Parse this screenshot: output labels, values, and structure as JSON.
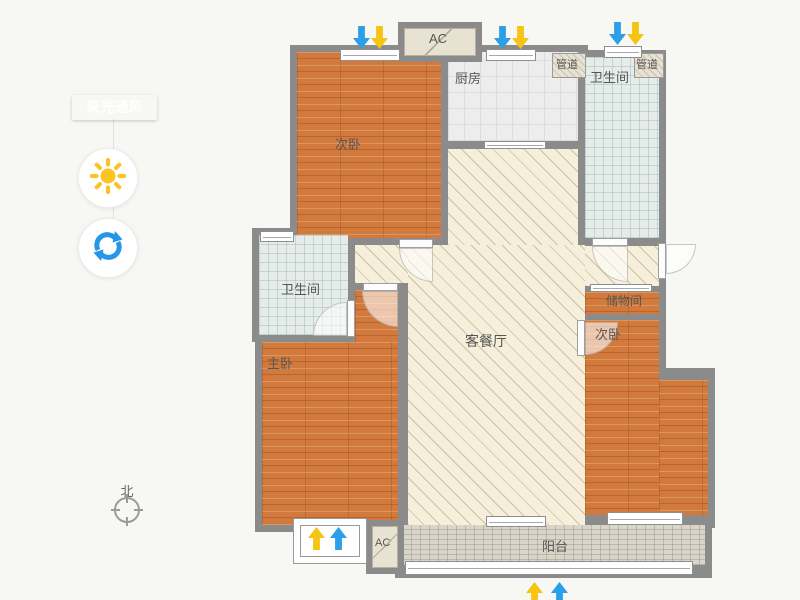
{
  "page": {
    "background": "#f7f7f4"
  },
  "sidebar": {
    "mode_label": "采光通风",
    "accent": "#1b9fe8",
    "buttons": [
      {
        "name": "sun",
        "meaning": "daylight view"
      },
      {
        "name": "rotate",
        "meaning": "rotate plan"
      }
    ]
  },
  "compass": {
    "label": "北"
  },
  "palette": {
    "wall": "#8b8b8b",
    "wood": "#d2793d",
    "hatch_bg": "#f5efdb",
    "tile_bg": "#ededed",
    "bath_bg": "#e5ece9",
    "balcony_bg": "#d9d5c8",
    "beige": "#e8e2d2",
    "arrow_blue": "#2b9fe8",
    "arrow_yellow": "#f6c413",
    "label_color": "#565656"
  },
  "floorplan": {
    "walls": [
      [
        290,
        45,
        158,
        203
      ],
      [
        441,
        45,
        147,
        103
      ],
      [
        578,
        50,
        88,
        195
      ],
      [
        441,
        141,
        147,
        111
      ],
      [
        252,
        228,
        103,
        114
      ],
      [
        255,
        283,
        157,
        249
      ],
      [
        348,
        238,
        240,
        294
      ],
      [
        578,
        225,
        88,
        155
      ],
      [
        578,
        368,
        137,
        160
      ],
      [
        395,
        515,
        317,
        63
      ]
    ],
    "floors": [
      {
        "kind": "wood",
        "r": [
          297,
          52,
          144,
          186
        ],
        "room": "bedroom-top-left"
      },
      {
        "kind": "tile",
        "r": [
          448,
          52,
          130,
          89
        ],
        "room": "kitchen"
      },
      {
        "kind": "bath",
        "r": [
          585,
          57,
          74,
          181
        ],
        "room": "bathroom-right"
      },
      {
        "kind": "hatch",
        "r": [
          448,
          149,
          130,
          96
        ],
        "room": "living-upper"
      },
      {
        "kind": "hatch",
        "r": [
          408,
          245,
          177,
          280
        ],
        "room": "living-main"
      },
      {
        "kind": "hatch",
        "r": [
          355,
          245,
          53,
          38
        ],
        "room": "living-left"
      },
      {
        "kind": "hatch",
        "r": [
          585,
          246,
          74,
          40
        ],
        "room": "hallway"
      },
      {
        "kind": "bath",
        "r": [
          259,
          235,
          89,
          100
        ],
        "room": "bathroom-left"
      },
      {
        "kind": "wood",
        "r": [
          355,
          290,
          43,
          52
        ],
        "room": "master-bedroom-top"
      },
      {
        "kind": "wood",
        "r": [
          262,
          342,
          136,
          183
        ],
        "room": "master-bedroom"
      },
      {
        "kind": "wood",
        "r": [
          585,
          292,
          74,
          22
        ],
        "room": "storage"
      },
      {
        "kind": "wood",
        "r": [
          585,
          320,
          74,
          195
        ],
        "room": "bedroom-right"
      },
      {
        "kind": "wood",
        "r": [
          659,
          380,
          49,
          135
        ],
        "room": "bedroom-right-ext"
      },
      {
        "kind": "balcony",
        "r": [
          402,
          525,
          303,
          40
        ],
        "room": "balcony"
      }
    ],
    "windows": [
      [
        340,
        49,
        60,
        12
      ],
      [
        486,
        49,
        50,
        12
      ],
      [
        604,
        46,
        38,
        12
      ],
      [
        260,
        231,
        34,
        11
      ],
      [
        590,
        284,
        62,
        8
      ],
      [
        607,
        512,
        76,
        13
      ],
      [
        486,
        516,
        60,
        11
      ],
      [
        405,
        561,
        288,
        14
      ],
      [
        484,
        141,
        62,
        8
      ]
    ],
    "doors": [
      {
        "leaf": [
          399,
          239,
          34,
          9
        ],
        "fan": [
          399,
          248,
          34,
          34
        ],
        "corner": "tr",
        "name": "bedroom-top-left-door"
      },
      {
        "leaf": [
          592,
          238,
          36,
          8
        ],
        "fan": [
          592,
          246,
          36,
          36
        ],
        "corner": "tr",
        "name": "bathroom-right-door"
      },
      {
        "leaf": [
          658,
          243,
          8,
          36
        ],
        "fan": [
          666,
          244,
          30,
          30
        ],
        "corner": "tl",
        "name": "entry-door"
      },
      {
        "leaf": [
          347,
          300,
          8,
          37
        ],
        "fan": [
          313,
          302,
          34,
          34
        ],
        "corner": "br",
        "name": "bathroom-left-door"
      },
      {
        "leaf": [
          363,
          283,
          35,
          8
        ],
        "fan": [
          362,
          291,
          36,
          36
        ],
        "corner": "tr",
        "name": "master-bedroom-door"
      },
      {
        "leaf": [
          577,
          320,
          8,
          36
        ],
        "fan": [
          585,
          322,
          33,
          33
        ],
        "corner": "tl",
        "name": "bedroom-right-door"
      }
    ],
    "ac_units": [
      {
        "frame": [
          398,
          22,
          84,
          40
        ],
        "fill": [
          404,
          28,
          72,
          28
        ]
      },
      {
        "frame": [
          366,
          520,
          38,
          54
        ],
        "fill": [
          372,
          526,
          26,
          42
        ]
      }
    ],
    "ducts": [
      [
        552,
        53,
        34,
        25
      ],
      [
        634,
        53,
        30,
        25
      ]
    ],
    "bay_window": {
      "outer": [
        293,
        518,
        74,
        46
      ],
      "inner": [
        300,
        525,
        60,
        32
      ]
    },
    "arrows": [
      {
        "dir": "down",
        "color": "blue",
        "x": 353,
        "y": 26
      },
      {
        "dir": "down",
        "color": "yellow",
        "x": 371,
        "y": 26
      },
      {
        "dir": "down",
        "color": "blue",
        "x": 494,
        "y": 26
      },
      {
        "dir": "down",
        "color": "yellow",
        "x": 512,
        "y": 26
      },
      {
        "dir": "down",
        "color": "blue",
        "x": 609,
        "y": 22
      },
      {
        "dir": "down",
        "color": "yellow",
        "x": 627,
        "y": 22
      },
      {
        "dir": "up",
        "color": "yellow",
        "x": 308,
        "y": 527
      },
      {
        "dir": "up",
        "color": "blue",
        "x": 330,
        "y": 527
      },
      {
        "dir": "up",
        "color": "yellow",
        "x": 526,
        "y": 582
      },
      {
        "dir": "up",
        "color": "blue",
        "x": 551,
        "y": 582
      }
    ],
    "labels": [
      {
        "text": "次卧",
        "x": 335,
        "y": 134,
        "fs": 13
      },
      {
        "text": "厨房",
        "x": 455,
        "y": 68,
        "fs": 13
      },
      {
        "text": "管道",
        "x": 556,
        "y": 56,
        "fs": 11
      },
      {
        "text": "卫生间",
        "x": 590,
        "y": 67,
        "fs": 13
      },
      {
        "text": "管道",
        "x": 636,
        "y": 56,
        "fs": 11
      },
      {
        "text": "卫生间",
        "x": 281,
        "y": 279,
        "fs": 13
      },
      {
        "text": "客餐厅",
        "x": 465,
        "y": 331,
        "fs": 14
      },
      {
        "text": "主卧",
        "x": 267,
        "y": 353,
        "fs": 13
      },
      {
        "text": "储物间",
        "x": 606,
        "y": 292,
        "fs": 12
      },
      {
        "text": "次卧",
        "x": 595,
        "y": 324,
        "fs": 13
      },
      {
        "text": "阳台",
        "x": 542,
        "y": 536,
        "fs": 13
      },
      {
        "text": "AC",
        "x": 429,
        "y": 31,
        "fs": 13
      },
      {
        "text": "AC",
        "x": 375,
        "y": 537,
        "fs": 11
      }
    ]
  }
}
